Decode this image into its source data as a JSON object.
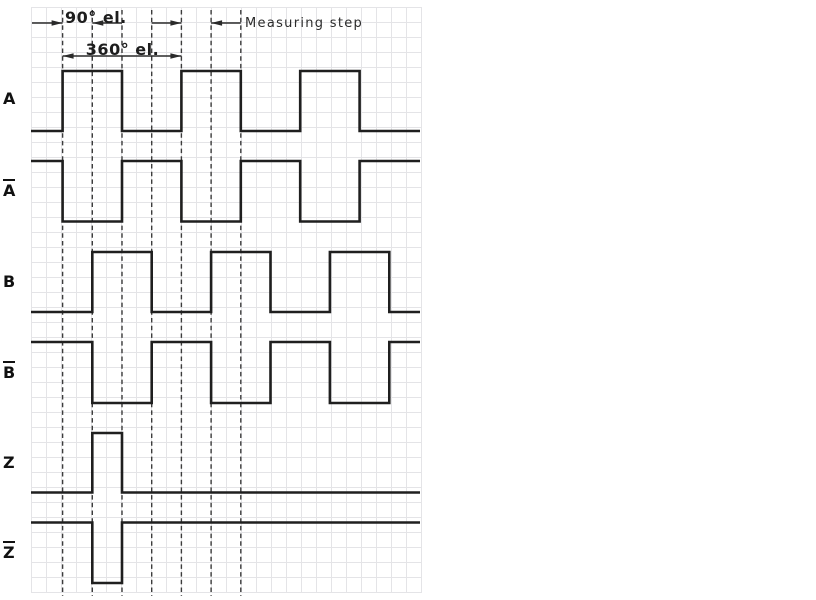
{
  "annotations": {
    "dim_90": "90° el.",
    "dim_360": "360° el.",
    "measuring_step": "Measuring step"
  },
  "signals": [
    {
      "id": "A",
      "label": "A",
      "overline": false,
      "initial_level": 0,
      "toggle_quarters": [
        0,
        2,
        4,
        6,
        8,
        10
      ],
      "y_high": 71,
      "y_low": 131
    },
    {
      "id": "A-bar",
      "label": "A",
      "overline": true,
      "initial_level": 1,
      "toggle_quarters": [
        0,
        2,
        4,
        6,
        8,
        10
      ],
      "y_high": 161,
      "y_low": 221.5
    },
    {
      "id": "B",
      "label": "B",
      "overline": false,
      "initial_level": 0,
      "toggle_quarters": [
        1,
        3,
        5,
        7,
        9,
        11
      ],
      "y_high": 252,
      "y_low": 312
    },
    {
      "id": "B-bar",
      "label": "B",
      "overline": true,
      "initial_level": 1,
      "toggle_quarters": [
        1,
        3,
        5,
        7,
        9,
        11
      ],
      "y_high": 342,
      "y_low": 403
    },
    {
      "id": "Z",
      "label": "Z",
      "overline": false,
      "initial_level": 0,
      "toggle_quarters": [
        1,
        2
      ],
      "y_high": 433,
      "y_low": 492.5
    },
    {
      "id": "Z-bar",
      "label": "Z",
      "overline": true,
      "initial_level": 1,
      "toggle_quarters": [
        1,
        2
      ],
      "y_high": 522.5,
      "y_low": 583
    }
  ],
  "geometry": {
    "x_origin": 62.6,
    "quarter_px": 29.7,
    "x_start": 31,
    "x_end": 420,
    "dashed_quarters": [
      0,
      1,
      2,
      3,
      4,
      5,
      6
    ],
    "dash_top": 10,
    "dash_bottom": 596,
    "dimensions": [
      {
        "x1": 32,
        "x2q": 0,
        "y": 23,
        "head": "end"
      },
      {
        "x1q": 1,
        "x2q": 2,
        "y": 23,
        "head": "start"
      },
      {
        "x1q": 0,
        "x2q": 4,
        "y": 56,
        "head": "both"
      },
      {
        "x1q": 3,
        "x2q": 4,
        "y": 23,
        "head": "end"
      },
      {
        "x1q": 5,
        "x2q": 6,
        "y": 23,
        "head": "start"
      }
    ]
  },
  "colors": {
    "background": "#ffffff",
    "grid": "#e4e4e7",
    "waveform": "#1f1f1f",
    "dashed": "#3c3c3c",
    "dimension": "#2a2a2a",
    "label": "#111111"
  }
}
